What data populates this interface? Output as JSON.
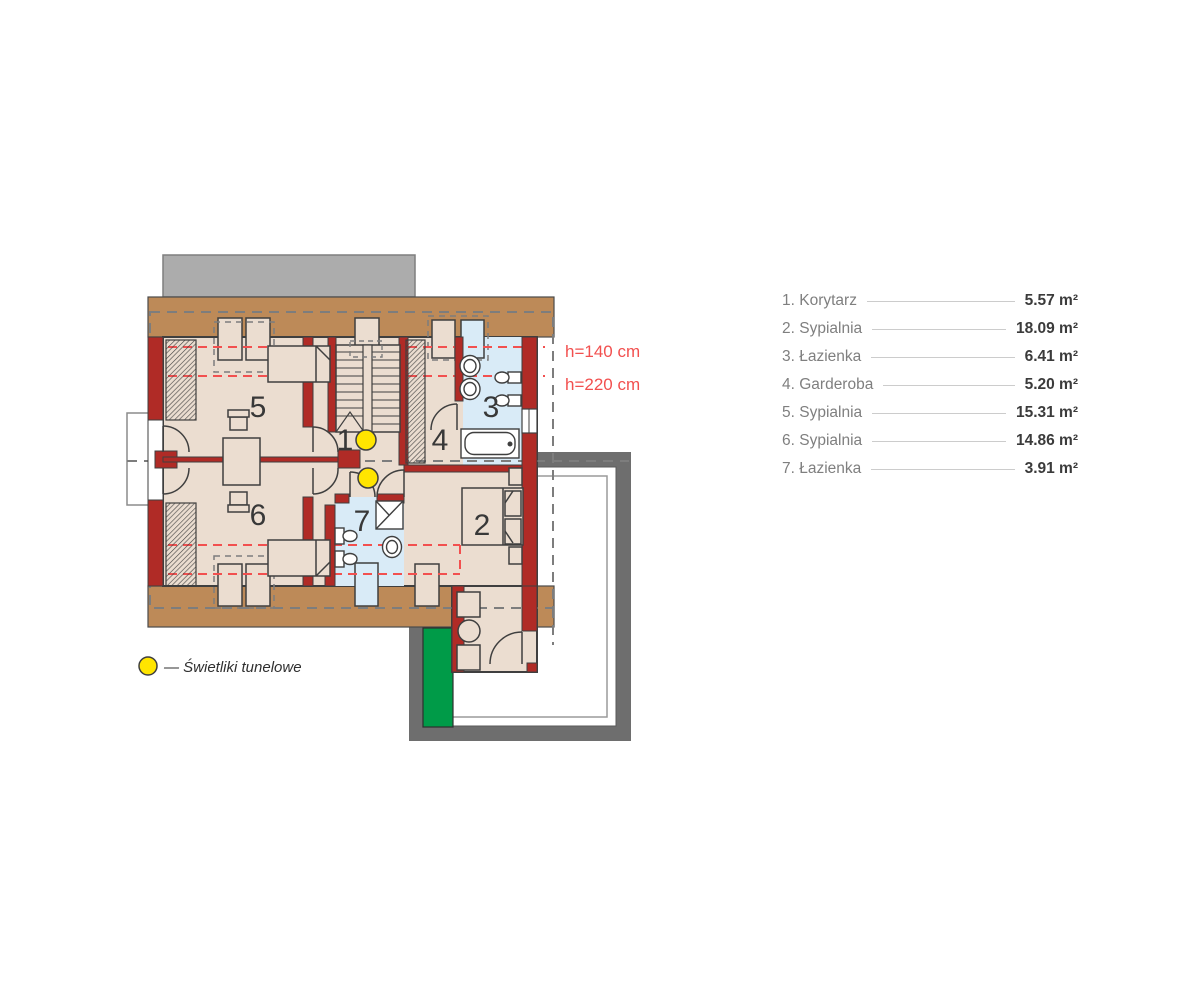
{
  "legend": {
    "items": [
      {
        "label": "1. Korytarz",
        "area": "5.57 m²"
      },
      {
        "label": "2. Sypialnia",
        "area": "18.09 m²"
      },
      {
        "label": "3. Łazienka",
        "area": "6.41 m²"
      },
      {
        "label": "4. Garderoba",
        "area": "5.20 m²"
      },
      {
        "label": "5. Sypialnia",
        "area": "15.31 m²"
      },
      {
        "label": "6. Sypialnia",
        "area": "14.86 m²"
      },
      {
        "label": "7. Łazienka",
        "area": "3.91 m²"
      }
    ]
  },
  "plan": {
    "room_numbers": [
      "1",
      "2",
      "3",
      "4",
      "5",
      "6",
      "7"
    ],
    "height_labels": {
      "upper": "h=140 cm",
      "lower": "h=220 cm"
    },
    "skylight_legend": "— Świetliki tunelowe"
  },
  "colors": {
    "wall_red": "#B02B26",
    "roof_band_brown": "#BD8A58",
    "floor_beige": "#EBDDD0",
    "bath_blue": "#D9EBF7",
    "terrace_frame_gray": "#6E6E6E",
    "roof_green": "#009B48",
    "skylight_yellow": "#FFE500",
    "dashed_red": "#F2504F",
    "chimney_gray": "#ACACAC"
  }
}
